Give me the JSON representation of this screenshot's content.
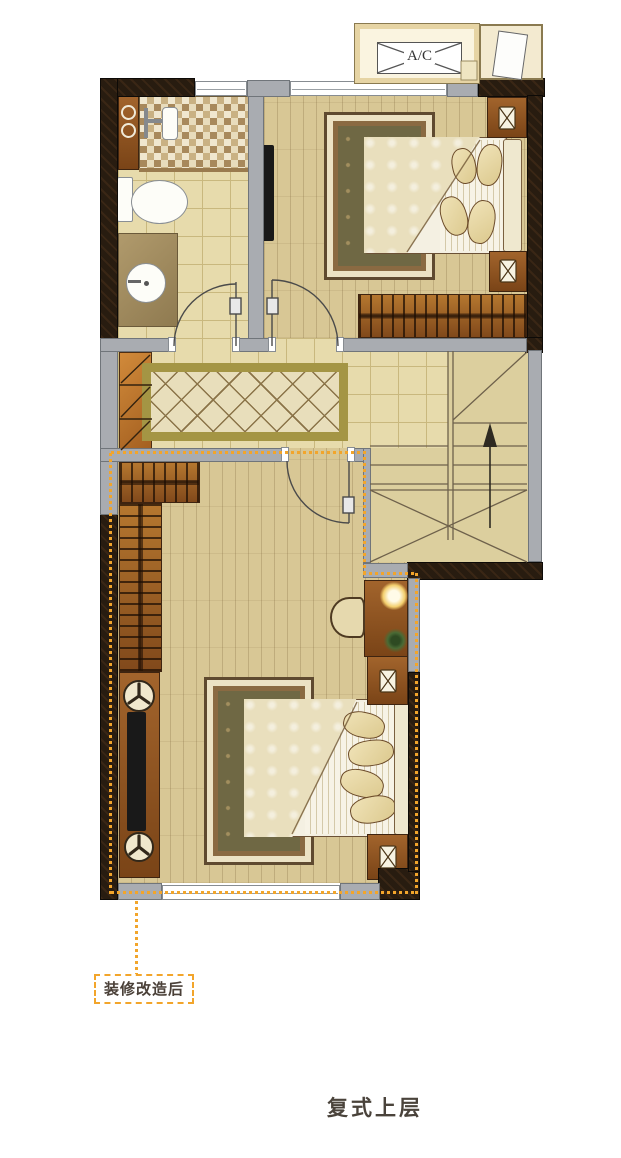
{
  "floorplan": {
    "ac_label": "A/C",
    "renovation_label": "装修改造后",
    "caption": "复式上层"
  },
  "colors": {
    "wall_dark": "#281c10",
    "wall_grey": "#a9acb1",
    "floor_wood": "#d8c795",
    "floor_tile": "#e7dbac",
    "stair_floor": "#dccf9e",
    "furniture_brown": "#9a5d28",
    "bedroom_rug_olive": "#6f6844",
    "hall_rug_border": "#a49544",
    "renovation_accent_orange": "#f2a52b",
    "blanket_cream": "#e9dfbd"
  }
}
